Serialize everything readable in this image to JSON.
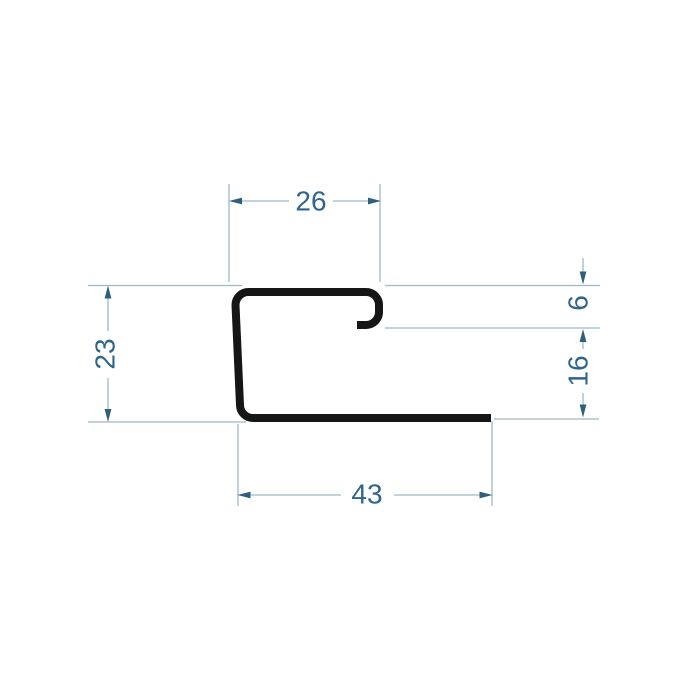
{
  "drawing": {
    "kind": "profile-cross-section-technical-drawing",
    "dimensions": {
      "top_width": "26",
      "left_height": "23",
      "hook_height": "6",
      "right_height": "16",
      "bottom_width": "43"
    },
    "colors": {
      "background": "#ffffff",
      "profile": "#161616",
      "dimension_lines": "#9fb9c9",
      "dimension_text": "#2f648c",
      "arrowheads": "#2d5f7e"
    }
  }
}
